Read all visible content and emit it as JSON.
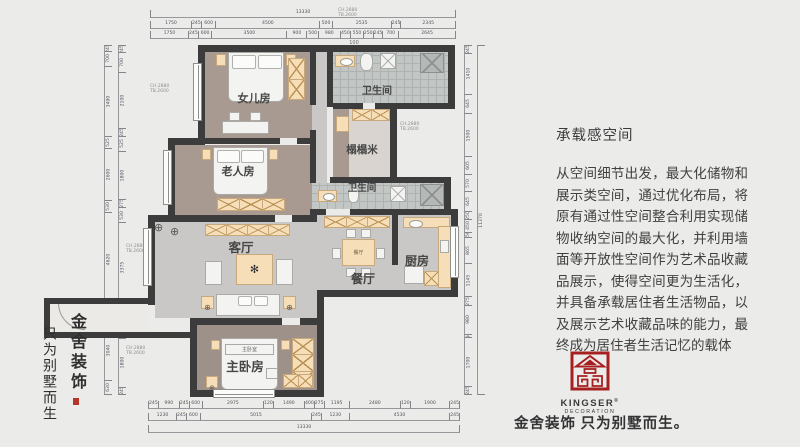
{
  "page": {
    "bg": "#ebebea"
  },
  "colors": {
    "wall": "#3c3c3c",
    "floor_taupe": "#a89a91",
    "floor_gray": "#c9c8c6",
    "cream_furniture": "#f6dfb8",
    "logo_red": "#a6201f"
  },
  "rooms": {
    "daughter": "女儿房",
    "bath1": "卫生间",
    "tatami": "榻榻米",
    "elder": "老人房",
    "bath2": "卫生间",
    "living": "客厅",
    "dining": "餐厅",
    "kitchen": "厨房",
    "master": "主卧房",
    "master_bed": "主卧室",
    "dining_table": "餐厅"
  },
  "plan": {
    "ann": {
      "l1": "CH.2880",
      "l2": "TB.2600"
    },
    "note": "100",
    "dims": {
      "top_total": [
        "13330"
      ],
      "top_row1": [
        "1750",
        "245",
        "600",
        "4500",
        "500",
        "2535",
        "245",
        "2345"
      ],
      "top_row2": [
        "1750",
        "245",
        "600",
        "3500",
        "900",
        "500",
        "980",
        "450",
        "550",
        "250",
        "245",
        "700",
        "2645"
      ],
      "bottom_row1": [
        "245",
        "990",
        "245",
        "600",
        "2975",
        "120",
        "1490",
        "400",
        "275",
        "1195",
        "2480",
        "120",
        "1900",
        "245"
      ],
      "bottom_row2": [
        "1230",
        "245",
        "600",
        "5015",
        "245",
        "1230",
        "4530",
        "245"
      ],
      "bottom_total": [
        "13330"
      ],
      "left_row1": [
        "245",
        "700",
        "3490",
        "525",
        "2600",
        "530",
        "4620",
        "650",
        "3040",
        "630"
      ],
      "left_row2": [
        "245",
        "700",
        "2100",
        "245",
        "525",
        "1800",
        "275",
        "530",
        "3375",
        "275",
        "630",
        "1800",
        "245"
      ],
      "right_row1": [
        "245",
        "1410",
        "645",
        "1500",
        "605",
        "570",
        "645",
        "250",
        "450",
        "150",
        "865",
        "1145",
        "275",
        "980",
        "90",
        "1700",
        "245"
      ],
      "right_row2": [
        "11370"
      ]
    }
  },
  "article": {
    "title": "承载感空间",
    "body": "从空间细节出发，最大化储物和展示类空间，通过优化布局，将原有通过性空间整合利用实现储物收纳空间的最大化，并利用墙面等开放性空间作为艺术品收藏品展示，使得空间更为生活化，并具备承载居住者生活物品，以及展示艺术收藏品味的能力，最终成为居住者生活记忆的载体"
  },
  "brand": {
    "logo_title": "KINGSER",
    "logo_reg": "®",
    "logo_sub": "DECORATION",
    "slogan_bold": "金舍装饰",
    "slogan_rest": "只为别墅而生。",
    "vertical_1": "金舍装饰",
    "vertical_2": "只为别墅而生"
  }
}
